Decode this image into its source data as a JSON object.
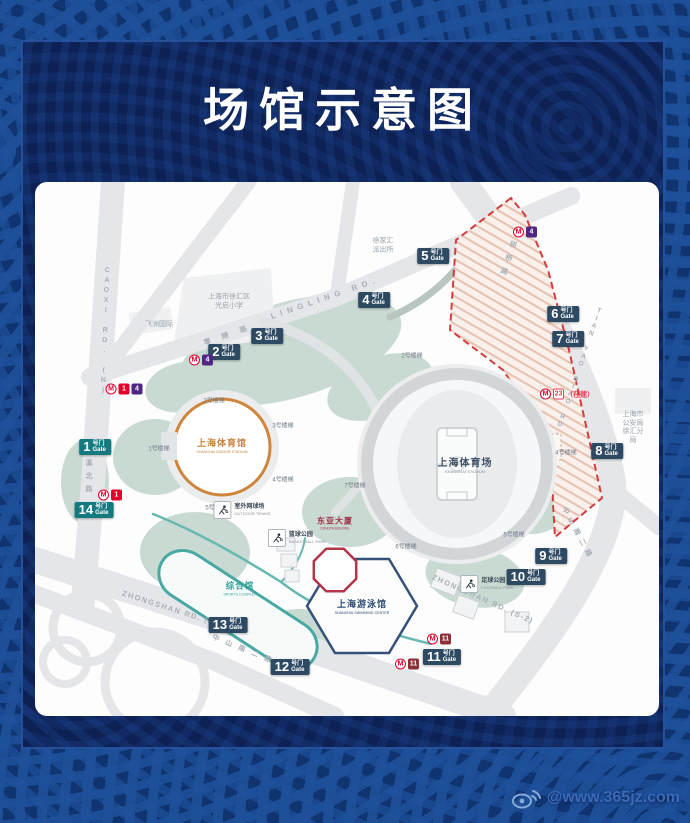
{
  "title": "场馆示意图",
  "watermark": {
    "text": "@www.365jz.com"
  },
  "map": {
    "venues": {
      "indoor_stadium": {
        "cn": "上海体育馆",
        "en": "SHANGHAI INDOOR STADIUM"
      },
      "stadium": {
        "cn": "上海体育场",
        "en": "SHANGHAI STADIUM"
      },
      "swimming": {
        "cn": "上海游泳馆",
        "en": "SHANGHAI SWIMMING CENTER"
      },
      "complex": {
        "cn": "综合馆",
        "en": "SPORTS COMPLEX"
      },
      "dongya": {
        "cn": "东亚大厦",
        "en": "DONGYA BUILDING"
      }
    },
    "gate_suffix": {
      "cn": "号门",
      "en": "Gate"
    },
    "gates": [
      {
        "n": "1",
        "x": 60,
        "y": 265,
        "teal": true
      },
      {
        "n": "2",
        "x": 189,
        "y": 170
      },
      {
        "n": "3",
        "x": 232,
        "y": 154
      },
      {
        "n": "4",
        "x": 339,
        "y": 118
      },
      {
        "n": "5",
        "x": 398,
        "y": 74
      },
      {
        "n": "6",
        "x": 528,
        "y": 132
      },
      {
        "n": "7",
        "x": 533,
        "y": 157
      },
      {
        "n": "8",
        "x": 572,
        "y": 269
      },
      {
        "n": "9",
        "x": 516,
        "y": 374
      },
      {
        "n": "10",
        "x": 491,
        "y": 395
      },
      {
        "n": "11",
        "x": 407,
        "y": 475
      },
      {
        "n": "12",
        "x": 255,
        "y": 485
      },
      {
        "n": "13",
        "x": 193,
        "y": 443
      },
      {
        "n": "14",
        "x": 59,
        "y": 328,
        "teal": true
      }
    ],
    "metro": {
      "logo_glyph": "M",
      "line_colors": {
        "1": "#e3002b",
        "4": "#4f2683",
        "11": "#8c2f39",
        "23": "#e8425a"
      },
      "stations": [
        {
          "x": 166,
          "y": 178,
          "lines": [
            "4"
          ]
        },
        {
          "x": 89,
          "y": 207,
          "lines": [
            "1",
            "4"
          ]
        },
        {
          "x": 75,
          "y": 313,
          "lines": [
            "1"
          ]
        },
        {
          "x": 490,
          "y": 50,
          "lines": [
            "4"
          ]
        },
        {
          "x": 532,
          "y": 212,
          "lines": [
            "23"
          ],
          "note": "（在建）"
        },
        {
          "x": 404,
          "y": 457,
          "lines": [
            "11"
          ]
        },
        {
          "x": 372,
          "y": 482,
          "lines": [
            "11"
          ]
        }
      ]
    },
    "parks": [
      {
        "cn": "室外网球场",
        "en": "OUTDOOR TENNIS",
        "x": 207,
        "y": 328,
        "icon": "tennis-player-icon"
      },
      {
        "cn": "篮球公园",
        "en": "BASKETBALL PARK",
        "x": 262,
        "y": 356,
        "icon": "basketball-player-icon"
      },
      {
        "cn": "足球公园",
        "en": "FOOTBALL PARK",
        "x": 452,
        "y": 402,
        "icon": "football-player-icon"
      }
    ],
    "stairs": [
      {
        "text": "1号楼梯",
        "x": 124,
        "y": 266
      },
      {
        "text": "2号楼梯",
        "x": 179,
        "y": 218
      },
      {
        "text": "3号楼梯",
        "x": 248,
        "y": 243
      },
      {
        "text": "4号楼梯",
        "x": 248,
        "y": 297
      },
      {
        "text": "5号楼梯",
        "x": 181,
        "y": 325
      },
      {
        "text": "2号楼梯",
        "x": 377,
        "y": 173
      },
      {
        "text": "4号楼梯",
        "x": 531,
        "y": 270
      },
      {
        "text": "5号楼梯",
        "x": 479,
        "y": 352
      },
      {
        "text": "6号楼梯",
        "x": 371,
        "y": 364
      },
      {
        "text": "7号楼梯",
        "x": 320,
        "y": 303
      }
    ],
    "roads": [
      {
        "text": "CAOXI RD. (N)",
        "x": 70,
        "y": 150,
        "v": true,
        "rot": 2,
        "ls": 3,
        "fs": 7
      },
      {
        "text": "漕溪北路",
        "x": 53,
        "y": 290,
        "v": true,
        "rot": 0,
        "ls": 6,
        "fs": 7
      },
      {
        "text": "LINGLING RD.",
        "x": 290,
        "y": 116,
        "rot": -19,
        "ls": 5,
        "fs": 8
      },
      {
        "text": "零陵路",
        "x": 196,
        "y": 152,
        "rot": -19,
        "ls": 12,
        "fs": 7
      },
      {
        "text": "天钥桥路",
        "x": 474,
        "y": 72,
        "v": true,
        "rot": 18,
        "ls": 7,
        "fs": 7
      },
      {
        "text": "TIAN YAO QIAO RD.",
        "x": 543,
        "y": 190,
        "v": true,
        "rot": 19,
        "ls": 1,
        "fs": 6.5
      },
      {
        "text": "ZHONGSHAN RD. (S-2)",
        "x": 140,
        "y": 428,
        "rot": 18,
        "ls": 1.5,
        "fs": 7.5
      },
      {
        "text": "中山南二路",
        "x": 210,
        "y": 468,
        "rot": 22,
        "ls": 7,
        "fs": 7
      },
      {
        "text": "ZHONGSHAN RD. (S-2)",
        "x": 448,
        "y": 417,
        "rot": 24,
        "ls": 1.5,
        "fs": 7.5
      },
      {
        "text": "中山南二路",
        "x": 543,
        "y": 352,
        "rot": 62,
        "ls": 5,
        "fs": 7
      }
    ],
    "places": [
      {
        "text": "上海市徐汇区\n光启小学",
        "x": 194,
        "y": 120
      },
      {
        "text": "飞洲国际",
        "x": 124,
        "y": 143
      },
      {
        "text": "徐家汇\n派出所",
        "x": 348,
        "y": 64
      },
      {
        "text": "上海市公安局\n徐汇分局",
        "x": 598,
        "y": 246
      }
    ]
  }
}
